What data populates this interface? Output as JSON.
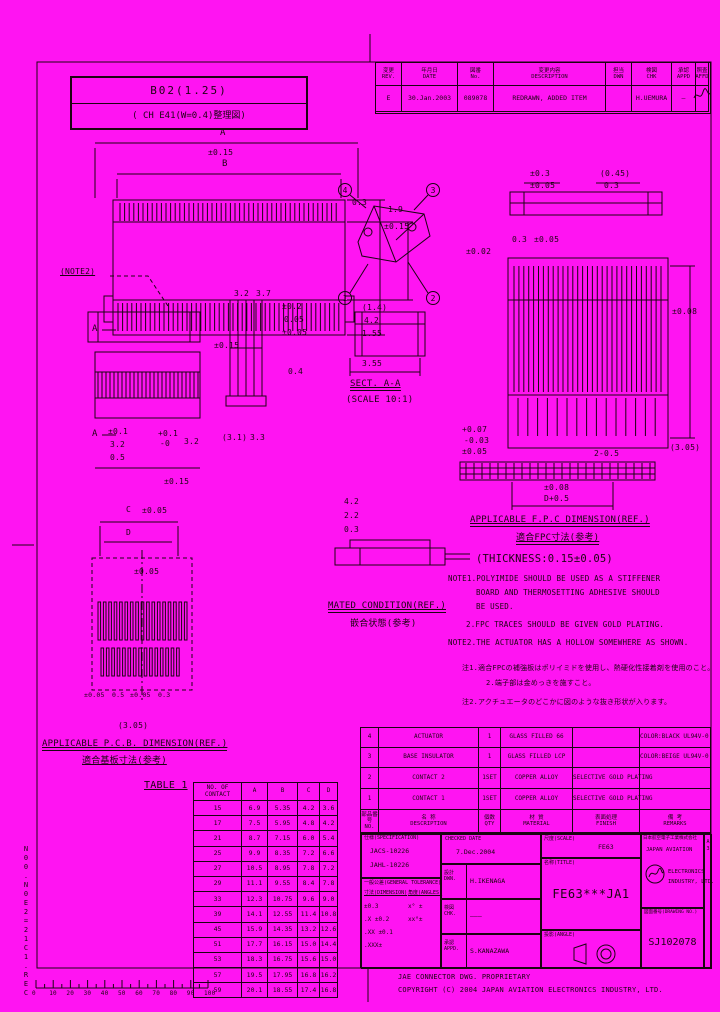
{
  "page": {
    "bg": "#ff14f2",
    "ink": "#1c0412"
  },
  "corner_box": {
    "line1": "B02(1.25)",
    "line2": "( CH E41(W=0.4)整理図)"
  },
  "revision": {
    "headers": [
      "変更\nREV.",
      "年月日\nDATE",
      "図番\nNo.",
      "変更内容\nDESCRIPTION",
      "担当\nDWN",
      "検図\nCHK",
      "承認\nAPPD",
      "照査\nAFFD"
    ],
    "row": [
      "E",
      "30.Jan.2003",
      "089078",
      "REDRAWN, ADDED ITEM",
      "",
      "H.UEMURA",
      "—",
      ""
    ]
  },
  "annotations": [
    {
      "x": 220,
      "y": 129,
      "t": "A",
      "fs": 9
    },
    {
      "x": 208,
      "y": 149,
      "t": "±0.15"
    },
    {
      "x": 222,
      "y": 160,
      "t": "B",
      "fs": 9
    },
    {
      "x": 60,
      "y": 268,
      "t": "(NOTE2)",
      "u": 1
    },
    {
      "x": 388,
      "y": 206,
      "t": "1.9"
    },
    {
      "x": 384,
      "y": 223,
      "t": "±0.15"
    },
    {
      "x": 214,
      "y": 342,
      "t": "±0.15"
    },
    {
      "x": 352,
      "y": 199,
      "t": "0.3"
    },
    {
      "x": 234,
      "y": 290,
      "t": "3.2"
    },
    {
      "x": 256,
      "y": 290,
      "t": "3.7"
    },
    {
      "x": 282,
      "y": 303,
      "t": "±0.2"
    },
    {
      "x": 284,
      "y": 316,
      "t": "0.05"
    },
    {
      "x": 282,
      "y": 329,
      "t": "±0.05"
    },
    {
      "x": 288,
      "y": 368,
      "t": "0.4"
    },
    {
      "x": 92,
      "y": 325,
      "t": "A",
      "fs": 9
    },
    {
      "x": 92,
      "y": 430,
      "t": "A",
      "fs": 9
    },
    {
      "x": 108,
      "y": 428,
      "t": "±0.1"
    },
    {
      "x": 110,
      "y": 441,
      "t": "3.2"
    },
    {
      "x": 110,
      "y": 454,
      "t": "0.5"
    },
    {
      "x": 158,
      "y": 430,
      "t": "+0.1"
    },
    {
      "x": 160,
      "y": 440,
      "t": "-0"
    },
    {
      "x": 184,
      "y": 438,
      "t": "3.2"
    },
    {
      "x": 222,
      "y": 434,
      "t": "(3.1)"
    },
    {
      "x": 250,
      "y": 434,
      "t": "3.3"
    },
    {
      "x": 164,
      "y": 478,
      "t": "±0.15"
    },
    {
      "x": 126,
      "y": 506,
      "t": "C"
    },
    {
      "x": 142,
      "y": 507,
      "t": "±0.05"
    },
    {
      "x": 126,
      "y": 529,
      "t": "D"
    },
    {
      "x": 134,
      "y": 568,
      "t": "±0.05"
    },
    {
      "x": 84,
      "y": 692,
      "t": "±0.05",
      "fs": 6.5
    },
    {
      "x": 112,
      "y": 692,
      "t": "0.5",
      "fs": 6.5
    },
    {
      "x": 130,
      "y": 692,
      "t": "±0.05",
      "fs": 6.5
    },
    {
      "x": 158,
      "y": 692,
      "t": "0.3",
      "fs": 6.5
    },
    {
      "x": 118,
      "y": 722,
      "t": "(3.05)"
    },
    {
      "x": 362,
      "y": 304,
      "t": "(1.4)"
    },
    {
      "x": 364,
      "y": 317,
      "t": "4.2"
    },
    {
      "x": 362,
      "y": 330,
      "t": "1.55"
    },
    {
      "x": 362,
      "y": 360,
      "t": "3.55"
    },
    {
      "x": 350,
      "y": 380,
      "t": "SECT. A-A",
      "fs": 9,
      "u": 2
    },
    {
      "x": 346,
      "y": 396,
      "t": "(SCALE 10:1)",
      "fs": 9
    },
    {
      "x": 530,
      "y": 170,
      "t": "±0.3"
    },
    {
      "x": 530,
      "y": 182,
      "t": "±0.05"
    },
    {
      "x": 600,
      "y": 170,
      "t": "(0.45)"
    },
    {
      "x": 604,
      "y": 182,
      "t": "0.3"
    },
    {
      "x": 512,
      "y": 236,
      "t": "0.3"
    },
    {
      "x": 534,
      "y": 236,
      "t": "±0.05"
    },
    {
      "x": 466,
      "y": 248,
      "t": "±0.02"
    },
    {
      "x": 672,
      "y": 308,
      "t": "±0.08"
    },
    {
      "x": 670,
      "y": 444,
      "t": "(3.05)"
    },
    {
      "x": 462,
      "y": 426,
      "t": "+0.07"
    },
    {
      "x": 464,
      "y": 437,
      "t": "-0.03"
    },
    {
      "x": 462,
      "y": 448,
      "t": "±0.05"
    },
    {
      "x": 594,
      "y": 450,
      "t": "2-0.5"
    },
    {
      "x": 544,
      "y": 484,
      "t": "±0.08"
    },
    {
      "x": 544,
      "y": 495,
      "t": "D+0.5"
    },
    {
      "x": 470,
      "y": 516,
      "t": "APPLICABLE F.P.C DIMENSION(REF.)",
      "fs": 9,
      "u": 2
    },
    {
      "x": 516,
      "y": 534,
      "t": "適合FPC寸法(参考)",
      "fs": 9,
      "u": 2
    },
    {
      "x": 476,
      "y": 554,
      "t": "(THICKNESS:0.15±0.05)",
      "fs": 10.5
    },
    {
      "x": 448,
      "y": 575,
      "t": "NOTE1.POLYIMIDE SHOULD BE USED AS A STIFFENER",
      "fs": 7.5
    },
    {
      "x": 476,
      "y": 589,
      "t": "BOARD AND THERMOSETTING ADHESIVE SHOULD",
      "fs": 7.5
    },
    {
      "x": 476,
      "y": 603,
      "t": "BE USED.",
      "fs": 7.5
    },
    {
      "x": 466,
      "y": 621,
      "t": "2.FPC TRACES SHOULD BE GIVEN GOLD PLATING.",
      "fs": 7.5
    },
    {
      "x": 448,
      "y": 639,
      "t": "NOTE2.THE ACTUATOR HAS A HOLLOW SOMEWHERE AS SHOWN.",
      "fs": 7.5
    },
    {
      "x": 462,
      "y": 665,
      "t": "注1.適合FPCの補強板はポリイミドを使用し、熱硬化性接着剤を使用のこと。",
      "fs": 7
    },
    {
      "x": 486,
      "y": 680,
      "t": "2.端子部は金めっきを施すこと。",
      "fs": 7
    },
    {
      "x": 462,
      "y": 699,
      "t": "注2.アクチュエータのどこかに図のような抜き形状が入ります。",
      "fs": 7
    },
    {
      "x": 344,
      "y": 498,
      "t": "4.2"
    },
    {
      "x": 344,
      "y": 512,
      "t": "2.2"
    },
    {
      "x": 344,
      "y": 526,
      "t": "0.3"
    },
    {
      "x": 328,
      "y": 602,
      "t": "MATED CONDITION(REF.)",
      "fs": 9,
      "u": 2
    },
    {
      "x": 350,
      "y": 620,
      "t": "嵌合状態(参考)",
      "fs": 9
    },
    {
      "x": 42,
      "y": 740,
      "t": "APPLICABLE P.C.B. DIMENSION(REF.)",
      "fs": 9,
      "u": 2
    },
    {
      "x": 82,
      "y": 757,
      "t": "適合基板寸法(参考)",
      "fs": 9,
      "u": 1
    },
    {
      "x": 144,
      "y": 781,
      "t": "TABLE 1",
      "fs": 10,
      "u": 1
    }
  ],
  "balloons": [
    {
      "x": 345,
      "y": 190,
      "n": "4"
    },
    {
      "x": 433,
      "y": 190,
      "n": "3"
    },
    {
      "x": 345,
      "y": 298,
      "n": "1"
    },
    {
      "x": 433,
      "y": 298,
      "n": "2"
    }
  ],
  "table1": {
    "col_headers": [
      "NO. OF\nCONTACT",
      "A",
      "B",
      "C",
      "D"
    ],
    "rows": [
      [
        "15",
        "6.9",
        "5.35",
        "4.2",
        "3.6"
      ],
      [
        "17",
        "7.5",
        "5.95",
        "4.8",
        "4.2"
      ],
      [
        "21",
        "8.7",
        "7.15",
        "6.0",
        "5.4"
      ],
      [
        "25",
        "9.9",
        "8.35",
        "7.2",
        "6.6"
      ],
      [
        "27",
        "10.5",
        "8.95",
        "7.8",
        "7.2"
      ],
      [
        "29",
        "11.1",
        "9.55",
        "8.4",
        "7.8"
      ],
      [
        "33",
        "12.3",
        "10.75",
        "9.6",
        "9.0"
      ],
      [
        "39",
        "14.1",
        "12.55",
        "11.4",
        "10.8"
      ],
      [
        "45",
        "15.9",
        "14.35",
        "13.2",
        "12.6"
      ],
      [
        "51",
        "17.7",
        "16.15",
        "15.0",
        "14.4"
      ],
      [
        "53",
        "18.3",
        "16.75",
        "15.6",
        "15.0"
      ],
      [
        "57",
        "19.5",
        "17.95",
        "16.8",
        "16.2"
      ],
      [
        "59",
        "20.1",
        "18.55",
        "17.4",
        "16.8"
      ]
    ]
  },
  "parts": {
    "headers": [
      "部品番号\nNO.",
      "名 称\nDESCRIPTION",
      "個数\nQTY",
      "材 質\nMATERIAL",
      "表面処理\nFINISH",
      "備 考\nREMARKS"
    ],
    "rows": [
      [
        "4",
        "ACTUATOR",
        "1",
        "GLASS FILLED 66",
        "",
        "COLOR:BLACK\nUL94V-0"
      ],
      [
        "3",
        "BASE INSULATOR",
        "1",
        "GLASS FILLED LCP",
        "",
        "COLOR:BEIGE\nUL94V-0"
      ],
      [
        "2",
        "CONTACT 2",
        "1SET",
        "COPPER ALLOY",
        "SELECTIVE GOLD PLATING",
        ""
      ],
      [
        "1",
        "CONTACT 1",
        "1SET",
        "COPPER ALLOY",
        "SELECTIVE GOLD PLATING",
        ""
      ]
    ]
  },
  "titleblock": {
    "spec_label": "仕様(SPECIFICATION)",
    "spec1": "JACS-10226",
    "spec2": "JAHL-10226",
    "tol_heading": "一般公差(GENERAL TOLERANCE)",
    "tol_dim": "寸法(DIMENSION)",
    "tol_ang": "角度(ANGLES)",
    "tol_rows": [
      [
        "±0.3",
        "x° ±"
      ],
      [
        ".X ±0.2",
        "xx°±"
      ],
      [
        ".XX ±0.1",
        ""
      ],
      [
        ".XXX±",
        ""
      ]
    ],
    "checked_label": "CHECKED DATE",
    "checked_date": "7.Dec.2004",
    "appr_rows": [
      {
        "label": "設計\nDWN.",
        "value": "H.IKENAGA"
      },
      {
        "label": "検図\nCHK.",
        "value": "———"
      },
      {
        "label": "承認\nAPPD.",
        "value": "S.KANAZAWA"
      }
    ],
    "scale_label": "尺度(SCALE)",
    "scale_value": "FE63",
    "title_label": "名称(TITLE)",
    "title_value": "FE63***JA1",
    "angle_label": "投影(ANGLE)",
    "dwgno_label": "図面番号(DRAWING NO.)",
    "dwgno_value": "SJ102078",
    "company_jp": "日本航空電子工業株式会社",
    "company_en1": "JAPAN AVIATION",
    "company_en2": "ELECTRONICS",
    "company_en3": "INDUSTRY, LTD.",
    "logo_text": "JAE",
    "sheet": "A3"
  },
  "footer": {
    "line1": "JAE CONNECTOR DWG. PROPRIETARY",
    "line2": "COPYRIGHT (C) 2004 JAPAN AVIATION ELECTRONICS INDUSTRY, LTD."
  },
  "ruler": {
    "labels": [
      "0",
      "10",
      "20",
      "30",
      "40",
      "50",
      "60",
      "70",
      "80",
      "90",
      "100"
    ]
  },
  "side_code": "N00.N0E2=21C1.REC"
}
